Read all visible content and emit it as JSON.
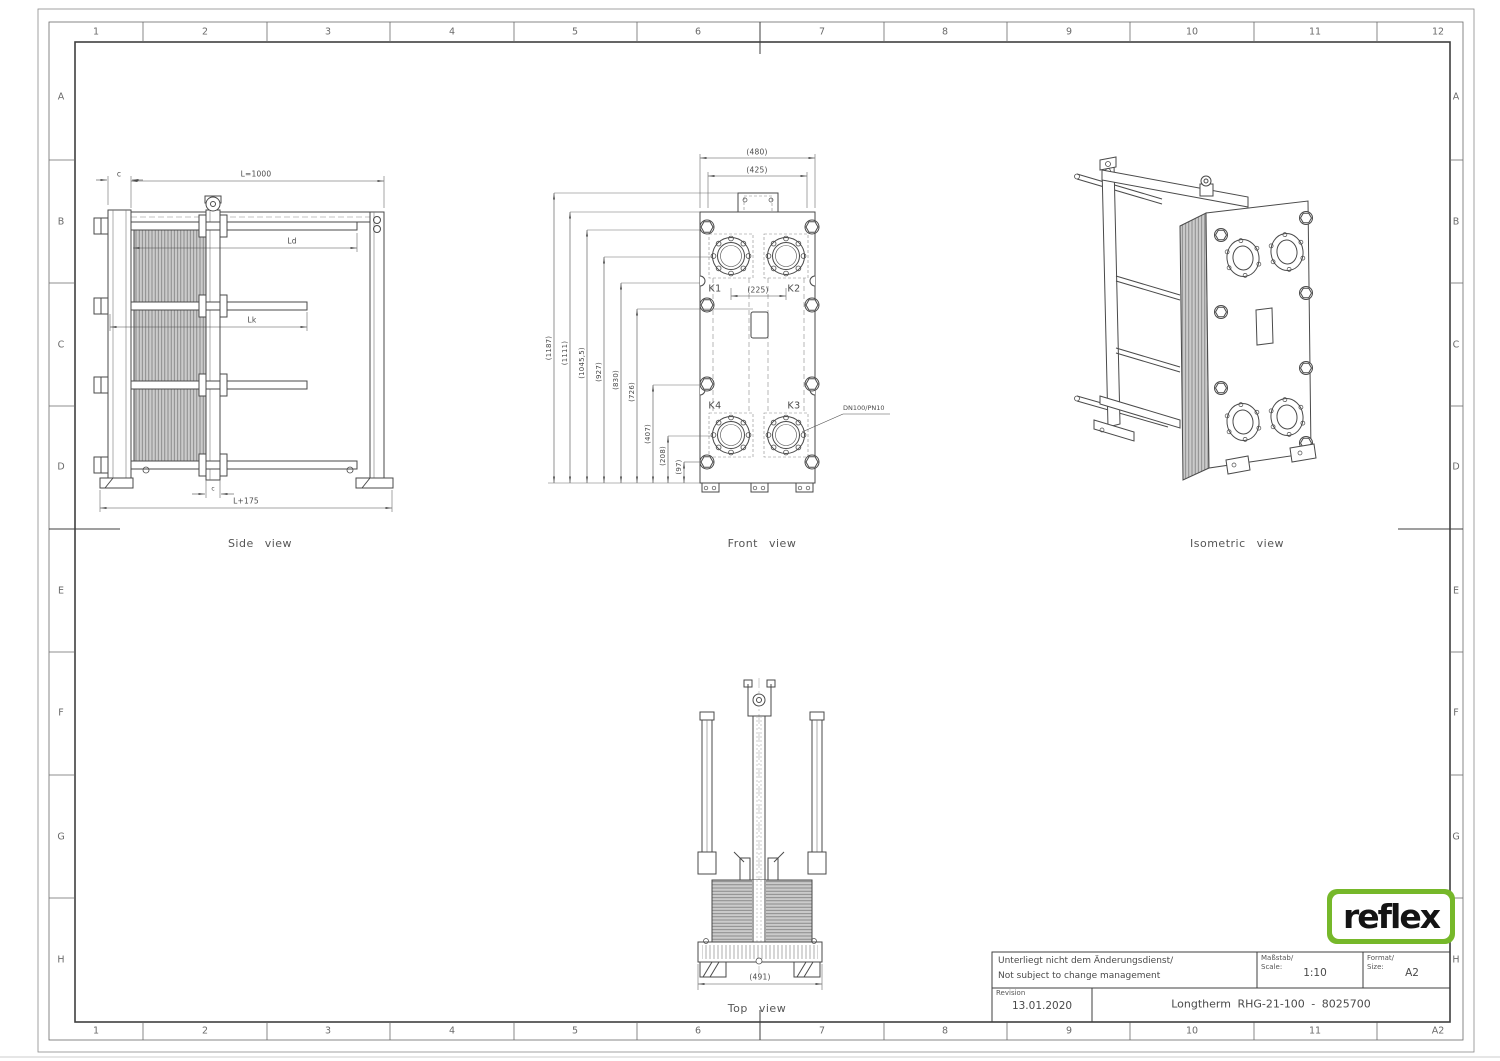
{
  "sheet": {
    "grid_top": [
      "1",
      "2",
      "3",
      "4",
      "5",
      "6",
      "7",
      "8",
      "9",
      "10",
      "11",
      "12"
    ],
    "grid_bottom": [
      "1",
      "2",
      "3",
      "4",
      "5",
      "6",
      "7",
      "8",
      "9",
      "10",
      "11",
      "A2"
    ],
    "grid_left": [
      "A",
      "B",
      "C",
      "D",
      "E",
      "F",
      "G",
      "H"
    ],
    "grid_right": [
      "A",
      "B",
      "C",
      "D",
      "E",
      "F",
      "G",
      "H"
    ]
  },
  "side_view": {
    "caption": "Side view",
    "dim_c_top": "c",
    "dim_length": "L=1000",
    "dim_ld": "Ld",
    "dim_lk": "Lk",
    "dim_c_bottom": "c",
    "dim_overall": "L+175"
  },
  "front_view": {
    "caption": "Front view",
    "dim_width_outer": "(480)",
    "dim_width_inner": "(425)",
    "dim_heights": [
      "(1187)",
      "(1111)",
      "(1045,5)",
      "(927)",
      "(830)",
      "(726)",
      "(407)",
      "(208)",
      "(97)"
    ],
    "dim_port_spacing": "(225)",
    "port_k1": "K1",
    "port_k2": "K2",
    "port_k3": "K3",
    "port_k4": "K4",
    "nozzle_spec": "DN100/PN10"
  },
  "isometric_view": {
    "caption": "Isometric view"
  },
  "top_view": {
    "caption": "Top view",
    "dim_width": "(491)"
  },
  "title_block": {
    "note_de": "Unterliegt nicht dem Änderungsdienst/",
    "note_en": "Not subject to change management",
    "scale_label_de": "Maßstab/",
    "scale_label_en": "Scale:",
    "scale_value": "1:10",
    "format_label_de": "Format/",
    "format_label_en": "Size:",
    "format_value": "A2",
    "revision_label": "Revision",
    "revision_date": "13.01.2020",
    "drawing_title": "Longtherm RHG-21-100 - 8025700",
    "logo_text": "reflex"
  },
  "colors": {
    "line": "#4a4a4a",
    "logo_green": "#76b82a",
    "pack_fill": "#cbcbcb"
  }
}
